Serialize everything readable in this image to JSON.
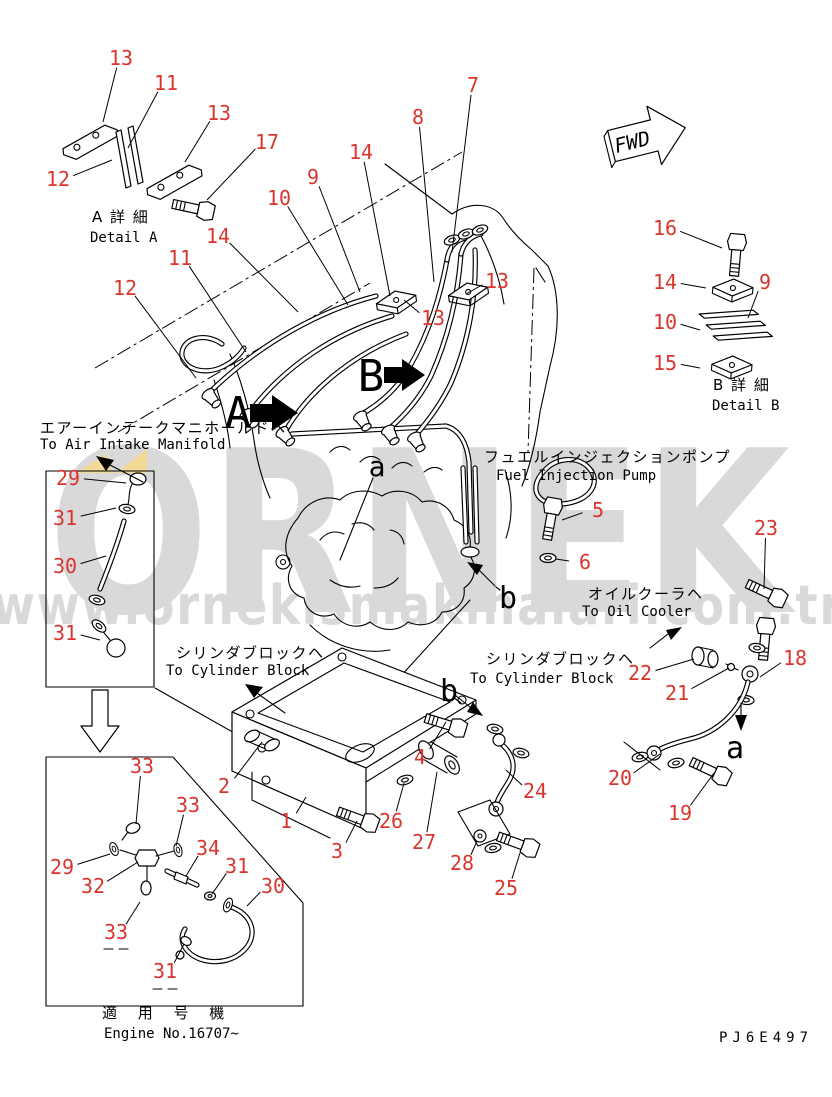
{
  "colors": {
    "line": "#000000",
    "callout": "#d8352e",
    "watermark": "#d9d9d9",
    "highlight": "#f2d996",
    "background": "#ffffff"
  },
  "watermark": {
    "name": "ORNEK",
    "url": "www.ornekismakinalari.com.tr"
  },
  "labels": {
    "fwd": "FWD",
    "part_code": "PJ6E497",
    "detail_a_jp": "A 詳 細",
    "detail_a_en": "Detail A",
    "detail_b_jp": "B 詳 細",
    "detail_b_en": "Detail B",
    "air_intake_jp": "エアーインテークマニホールドヘ",
    "air_intake_en": "To Air Intake Manifold",
    "fuel_pump_jp": "フュエルインジェクションポンプ",
    "fuel_pump_en": "Fuel Injection Pump",
    "cylinder_block_jp": "シリンダブロックヘ",
    "cylinder_block_en": "To Cylinder Block",
    "oil_cooler_jp": "オイルクーラヘ",
    "oil_cooler_en": "To Oil Cooler",
    "applicable_jp": "適 用 号 機",
    "applicable_en": "Engine No.16707~"
  },
  "view_letters": [
    {
      "t": "A",
      "x": 238,
      "y": 412,
      "s": 44
    },
    {
      "t": "B",
      "x": 371,
      "y": 375,
      "s": 44
    },
    {
      "t": "a",
      "x": 377,
      "y": 466,
      "s": 28
    },
    {
      "t": "b",
      "x": 508,
      "y": 597,
      "s": 30
    },
    {
      "t": "b",
      "x": 449,
      "y": 690,
      "s": 30
    },
    {
      "t": "a",
      "x": 735,
      "y": 747,
      "s": 30
    }
  ],
  "callouts": [
    {
      "n": "13",
      "x": 121,
      "y": 58,
      "tx": 103,
      "ty": 122
    },
    {
      "n": "11",
      "x": 166,
      "y": 83,
      "tx": 128,
      "ty": 148
    },
    {
      "n": "13",
      "x": 219,
      "y": 113,
      "tx": 185,
      "ty": 162
    },
    {
      "n": "17",
      "x": 267,
      "y": 142,
      "tx": 207,
      "ty": 200
    },
    {
      "n": "12",
      "x": 58,
      "y": 179,
      "tx": 112,
      "ty": 160
    },
    {
      "n": "10",
      "x": 279,
      "y": 198,
      "tx": 348,
      "ty": 305
    },
    {
      "n": "14",
      "x": 218,
      "y": 236,
      "tx": 298,
      "ty": 312
    },
    {
      "n": "11",
      "x": 180,
      "y": 258,
      "tx": 246,
      "ty": 352
    },
    {
      "n": "12",
      "x": 125,
      "y": 288,
      "tx": 196,
      "ty": 378
    },
    {
      "n": "7",
      "x": 473,
      "y": 85,
      "tx": 452,
      "ty": 252
    },
    {
      "n": "8",
      "x": 418,
      "y": 117,
      "tx": 434,
      "ty": 282
    },
    {
      "n": "14",
      "x": 361,
      "y": 152,
      "tx": 390,
      "ty": 296
    },
    {
      "n": "9",
      "x": 313,
      "y": 177,
      "tx": 360,
      "ty": 292
    },
    {
      "n": "13",
      "x": 497,
      "y": 281,
      "tx": 466,
      "ty": 294
    },
    {
      "n": "13",
      "x": 433,
      "y": 318,
      "tx": 404,
      "ty": 300
    },
    {
      "n": "16",
      "x": 665,
      "y": 228,
      "tx": 722,
      "ty": 248
    },
    {
      "n": "14",
      "x": 665,
      "y": 282,
      "tx": 706,
      "ty": 288
    },
    {
      "n": "9",
      "x": 765,
      "y": 282,
      "tx": 748,
      "ty": 318
    },
    {
      "n": "10",
      "x": 665,
      "y": 322,
      "tx": 700,
      "ty": 330
    },
    {
      "n": "15",
      "x": 665,
      "y": 363,
      "tx": 700,
      "ty": 368
    },
    {
      "n": "29",
      "x": 68,
      "y": 478,
      "tx": 126,
      "ty": 483
    },
    {
      "n": "31",
      "x": 65,
      "y": 518,
      "tx": 116,
      "ty": 508
    },
    {
      "n": "30",
      "x": 65,
      "y": 566,
      "tx": 106,
      "ty": 556
    },
    {
      "n": "31",
      "x": 65,
      "y": 633,
      "tx": 100,
      "ty": 640
    },
    {
      "n": "5",
      "x": 598,
      "y": 510,
      "tx": 562,
      "ty": 520
    },
    {
      "n": "6",
      "x": 585,
      "y": 562,
      "tx": 556,
      "ty": 559
    },
    {
      "n": "23",
      "x": 766,
      "y": 528,
      "tx": 764,
      "ty": 589
    },
    {
      "n": "22",
      "x": 640,
      "y": 673,
      "tx": 694,
      "ty": 659
    },
    {
      "n": "21",
      "x": 677,
      "y": 693,
      "tx": 729,
      "ty": 668
    },
    {
      "n": "18",
      "x": 795,
      "y": 658,
      "tx": 760,
      "ty": 677
    },
    {
      "n": "20",
      "x": 620,
      "y": 778,
      "tx": 660,
      "ty": 754
    },
    {
      "n": "19",
      "x": 680,
      "y": 813,
      "tx": 714,
      "ty": 773
    },
    {
      "n": "2",
      "x": 224,
      "y": 786,
      "tx": 262,
      "ty": 742
    },
    {
      "n": "1",
      "x": 286,
      "y": 821,
      "tx": 306,
      "ty": 797
    },
    {
      "n": "3",
      "x": 337,
      "y": 851,
      "tx": 357,
      "ty": 821
    },
    {
      "n": "4",
      "x": 420,
      "y": 757,
      "tx": 446,
      "ty": 722
    },
    {
      "n": "26",
      "x": 391,
      "y": 821,
      "tx": 404,
      "ty": 783
    },
    {
      "n": "27",
      "x": 424,
      "y": 842,
      "tx": 437,
      "ty": 772
    },
    {
      "n": "28",
      "x": 462,
      "y": 863,
      "tx": 477,
      "ty": 841
    },
    {
      "n": "24",
      "x": 535,
      "y": 791,
      "tx": 506,
      "ty": 770
    },
    {
      "n": "25",
      "x": 506,
      "y": 888,
      "tx": 520,
      "ty": 853
    },
    {
      "n": "33",
      "x": 142,
      "y": 766,
      "tx": 136,
      "ty": 824
    },
    {
      "n": "33",
      "x": 188,
      "y": 805,
      "tx": 176,
      "ty": 846
    },
    {
      "n": "34",
      "x": 208,
      "y": 848,
      "tx": 186,
      "ty": 876
    },
    {
      "n": "29",
      "x": 62,
      "y": 867,
      "tx": 110,
      "ty": 854
    },
    {
      "n": "32",
      "x": 93,
      "y": 886,
      "tx": 138,
      "ty": 862
    },
    {
      "n": "31",
      "x": 237,
      "y": 866,
      "tx": 212,
      "ty": 894
    },
    {
      "n": "30",
      "x": 273,
      "y": 886,
      "tx": 247,
      "ty": 906
    },
    {
      "n": "33",
      "x": 116,
      "y": 932,
      "tx": 140,
      "ty": 902
    },
    {
      "n": "31",
      "x": 165,
      "y": 971,
      "tx": 184,
      "ty": 944
    }
  ]
}
